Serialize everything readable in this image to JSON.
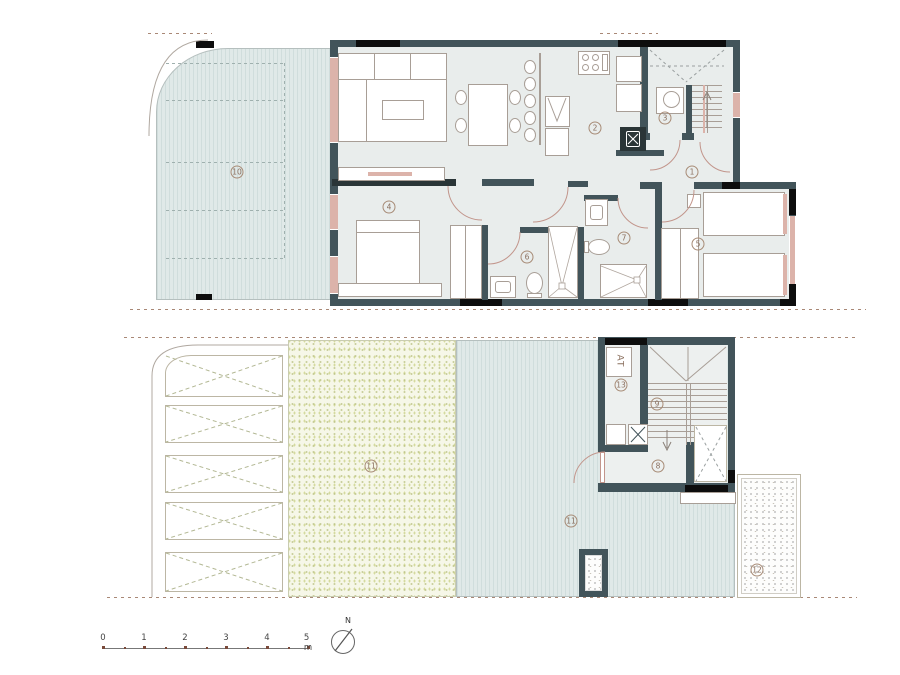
{
  "drawing": {
    "type": "two-level residential floor plan"
  },
  "colors": {
    "wall": "#42545a",
    "wall_black": "#0d0d0d",
    "floor": "#e9edec",
    "accent_pink": "#dcb3aa",
    "line": "#a89e96",
    "door_arc": "#c2958b",
    "terrace_base": "#e0e9e8",
    "terrace_stripe": "#d0dddc",
    "garden_base": "#f6f7e8",
    "boundary_dash": "#a98876"
  },
  "room_labels": [
    {
      "label": "1",
      "name": "hallway",
      "x": 692,
      "y": 172
    },
    {
      "label": "2",
      "name": "kitchen",
      "x": 595,
      "y": 128
    },
    {
      "label": "3",
      "name": "utility",
      "x": 665,
      "y": 118
    },
    {
      "label": "4",
      "name": "bedroom-main",
      "x": 389,
      "y": 207
    },
    {
      "label": "5",
      "name": "bedroom-twin",
      "x": 698,
      "y": 244
    },
    {
      "label": "6",
      "name": "bathroom-1",
      "x": 527,
      "y": 257
    },
    {
      "label": "7",
      "name": "bathroom-2",
      "x": 624,
      "y": 238
    },
    {
      "label": "8",
      "name": "entry-lower",
      "x": 658,
      "y": 466
    },
    {
      "label": "9",
      "name": "stairs-lower",
      "x": 657,
      "y": 404
    },
    {
      "label": "10",
      "name": "terrace-upper",
      "x": 237,
      "y": 172
    },
    {
      "label": "11",
      "name": "garden",
      "x": 371,
      "y": 466
    },
    {
      "label": "11",
      "name": "terrace-lower",
      "x": 571,
      "y": 521
    },
    {
      "label": "12",
      "name": "gravel-patio",
      "x": 757,
      "y": 570
    },
    {
      "label": "13",
      "name": "closet-at",
      "x": 621,
      "y": 385
    }
  ],
  "annotations": {
    "at_label": "AT",
    "north_label": "N"
  },
  "scale_bar": {
    "labels": [
      "0",
      "1",
      "2",
      "3",
      "4",
      "5 m"
    ],
    "start_x": 103,
    "spacing_px": 41,
    "baseline_y": 648
  }
}
